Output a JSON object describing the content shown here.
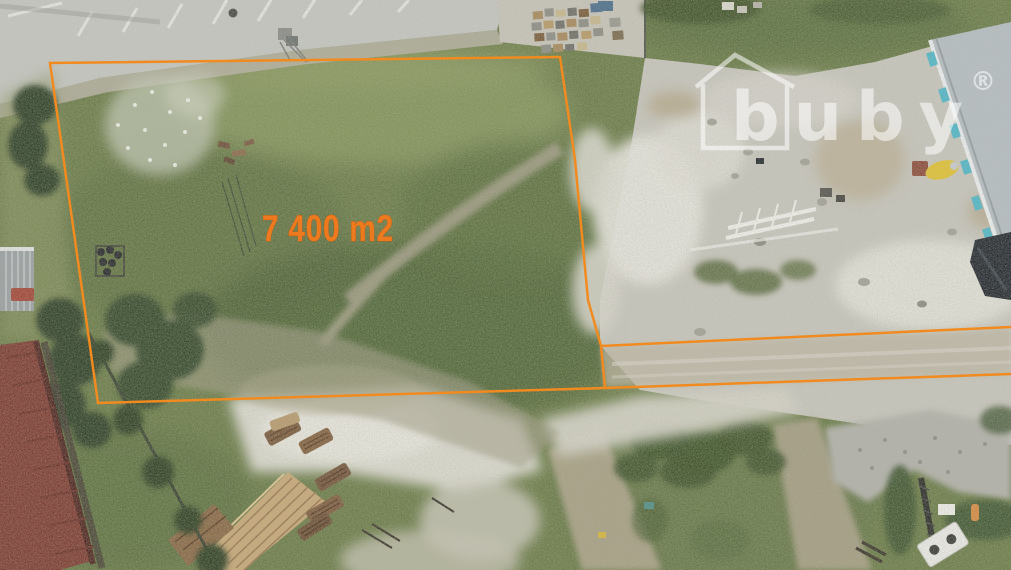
{
  "annotation": {
    "area_label": "7 400 m2",
    "boundary_color": "#F18A1F",
    "label_color": "#ED7A1E"
  },
  "watermark": {
    "brand": "buby",
    "registered_symbol": "®",
    "color": "#FFFFFF",
    "icon": "house-outline-icon"
  },
  "scene": {
    "colors": {
      "grass_green": "#6B7C47",
      "gravel_gray": "#C9C7BE",
      "sand_white": "#E2E0D5",
      "road_gray": "#C6C7C2",
      "roof_red": "#7D3A30",
      "roof_gray": "#B7BFC4",
      "dark_roof": "#23282E",
      "tree_green": "#2E4125",
      "dirt_tan": "#A69F85",
      "watermark_white": "#FFFFFF"
    }
  }
}
